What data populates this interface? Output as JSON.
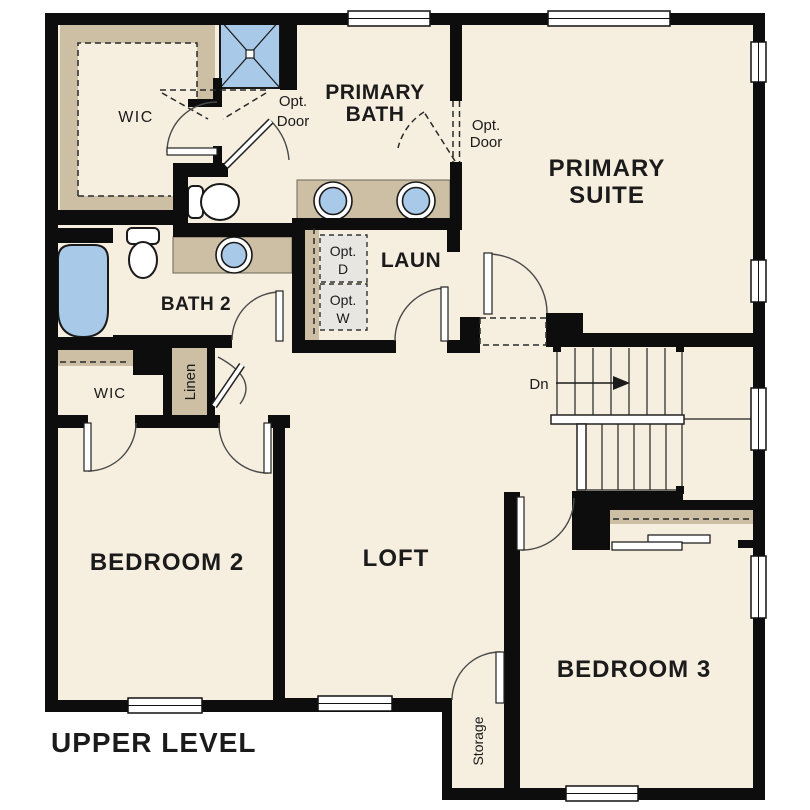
{
  "plan": {
    "type": "residential floor plan",
    "level": "upper"
  },
  "labels": {
    "wic_primary": "WIC",
    "primary_bath_l1": "PRIMARY",
    "primary_bath_l2": "BATH",
    "opt_door_shower_l1": "Opt.",
    "opt_door_shower_l2": "Door",
    "opt_door_suite_l1": "Opt.",
    "opt_door_suite_l2": "Door",
    "primary_suite_l1": "PRIMARY",
    "primary_suite_l2": "SUITE",
    "bath2": "BATH 2",
    "laundry": "LAUN",
    "opt_dryer_l1": "Opt.",
    "opt_dryer_l2": "D",
    "opt_washer_l1": "Opt.",
    "opt_washer_l2": "W",
    "wic_bedroom2": "WIC",
    "linen": "Linen",
    "stairs_direction": "Dn",
    "bedroom2": "BEDROOM 2",
    "loft": "LOFT",
    "bedroom3": "BEDROOM 3",
    "storage": "Storage",
    "plan_title": "UPPER LEVEL"
  },
  "colors": {
    "wall": "#0d0d0d",
    "floor": "#f6eedf",
    "cabinetry_tan": "#ccbfa4",
    "fixture_blue": "#a9c9e8",
    "optional_appliance_gray": "#e7e6e2",
    "background": "#ffffff",
    "text": "#1b1b1b"
  }
}
